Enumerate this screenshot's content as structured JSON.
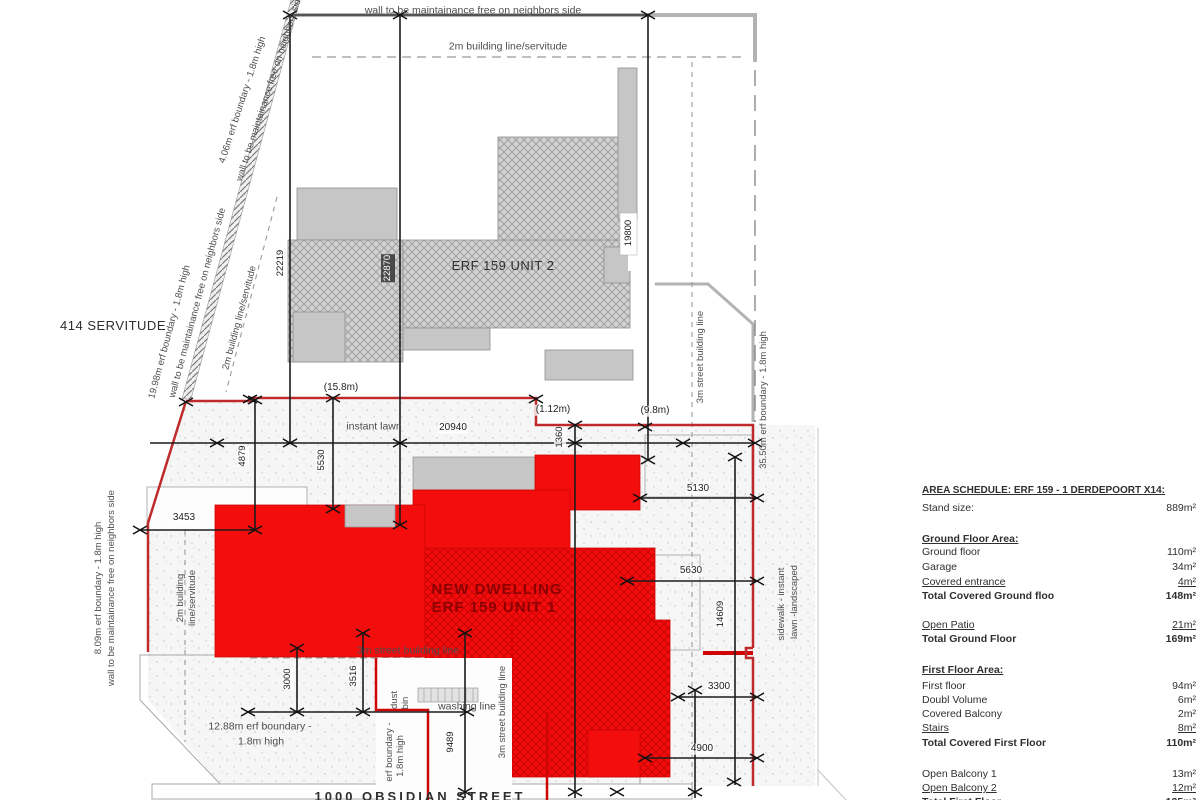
{
  "colors": {
    "boundary_red": "#bf2b2b",
    "dwelling_red": "#f30d0d",
    "building_gray": "#c6c6c6"
  },
  "drawing": {
    "servitude": "414 SERVITUDE",
    "street_name": "1000 OBSIDIAN STREET",
    "unit2_label": "ERF 159 UNIT 2",
    "unit1_line1": "NEW DWELLING",
    "unit1_line2": "ERF 159 UNIT 1",
    "notes": {
      "wall_top": "wall to be maintainance free on neighbors side",
      "building_line_2m": "2m building line/servitude",
      "diag1_l1": "4.06m erf boundary - 1.8m high",
      "diag1_l2": "wall to be maintainance free on neighbors side",
      "diag2_l1": "19.98m erf boundary - 1.8m high",
      "diag2_l2": "wall to be maintainance free on neighbors side",
      "bl2m_diag": "2m building line/servitude",
      "left_l1": "8.09m erf boundary - 1.8m high",
      "left_l2": "wall to be maintainance free on neighbors side",
      "bl2m_l1": "2m building",
      "bl2m_l2": "line/servitude",
      "instant_lawn": "instant lawn",
      "street_bl_3m": "3m street building line",
      "boundary_1288_l1": "12.88m erf boundary -",
      "boundary_1288_l2": "1.8m high",
      "dust_l1": "dust",
      "dust_l2": "bin",
      "washing_line": "washing line",
      "erf_small_l1": "erf boundary -",
      "erf_small_l2": "1.8m high",
      "boundary_3550": "35.50m erf boundary - 1.8m high",
      "sidewalk_l1": "sidewalk - instant",
      "sidewalk_l2": "lawn -landscaped"
    },
    "dims": {
      "d22219": "22219",
      "d22870": "22870",
      "d19800": "19800",
      "d20940": "20940",
      "d3453": "3453",
      "d4879": "4879",
      "d5530": "5530",
      "d1360": "1360",
      "d5130": "5130",
      "d5630": "5630",
      "d14609": "14609",
      "d3300": "3300",
      "d4900": "4900",
      "d3000": "3000",
      "d3516": "3516",
      "d9489": "9489",
      "m158": "(15.8m)",
      "m112": "(1.12m)",
      "m98": "(9.8m)"
    }
  },
  "schedule": {
    "title": "AREA SCHEDULE: ERF 159 - 1 DERDEPOORT X14:",
    "stand": {
      "label": "Stand size:",
      "value": "889m²"
    },
    "ground_header": "Ground Floor Area:",
    "g1": {
      "label": "Ground floor",
      "value": "110m²"
    },
    "g2": {
      "label": "Garage",
      "value": "34m²"
    },
    "g3": {
      "label": "Covered entrance",
      "value": "4m²"
    },
    "g4": {
      "label": "Total Covered Ground floo",
      "value": "148m²"
    },
    "g5": {
      "label": "Open Patio",
      "value": "21m²"
    },
    "g6": {
      "label": "Total Ground Floor",
      "value": "169m²"
    },
    "first_header": "First Floor Area:",
    "f1": {
      "label": "First floor",
      "value": "94m²"
    },
    "f2": {
      "label": "Doubl Volume",
      "value": "6m²"
    },
    "f3": {
      "label": "Covered Balcony",
      "value": "2m²"
    },
    "f4": {
      "label": "Stairs",
      "value": "8m²"
    },
    "f5": {
      "label": "Total Covered First Floor",
      "value": "110m²"
    },
    "f6": {
      "label": "Open Balcony 1",
      "value": "13m²"
    },
    "f7": {
      "label": "Open Balcony 2",
      "value": "12m²"
    },
    "f8": {
      "label": "Total First Floor",
      "value": "135m²"
    }
  }
}
